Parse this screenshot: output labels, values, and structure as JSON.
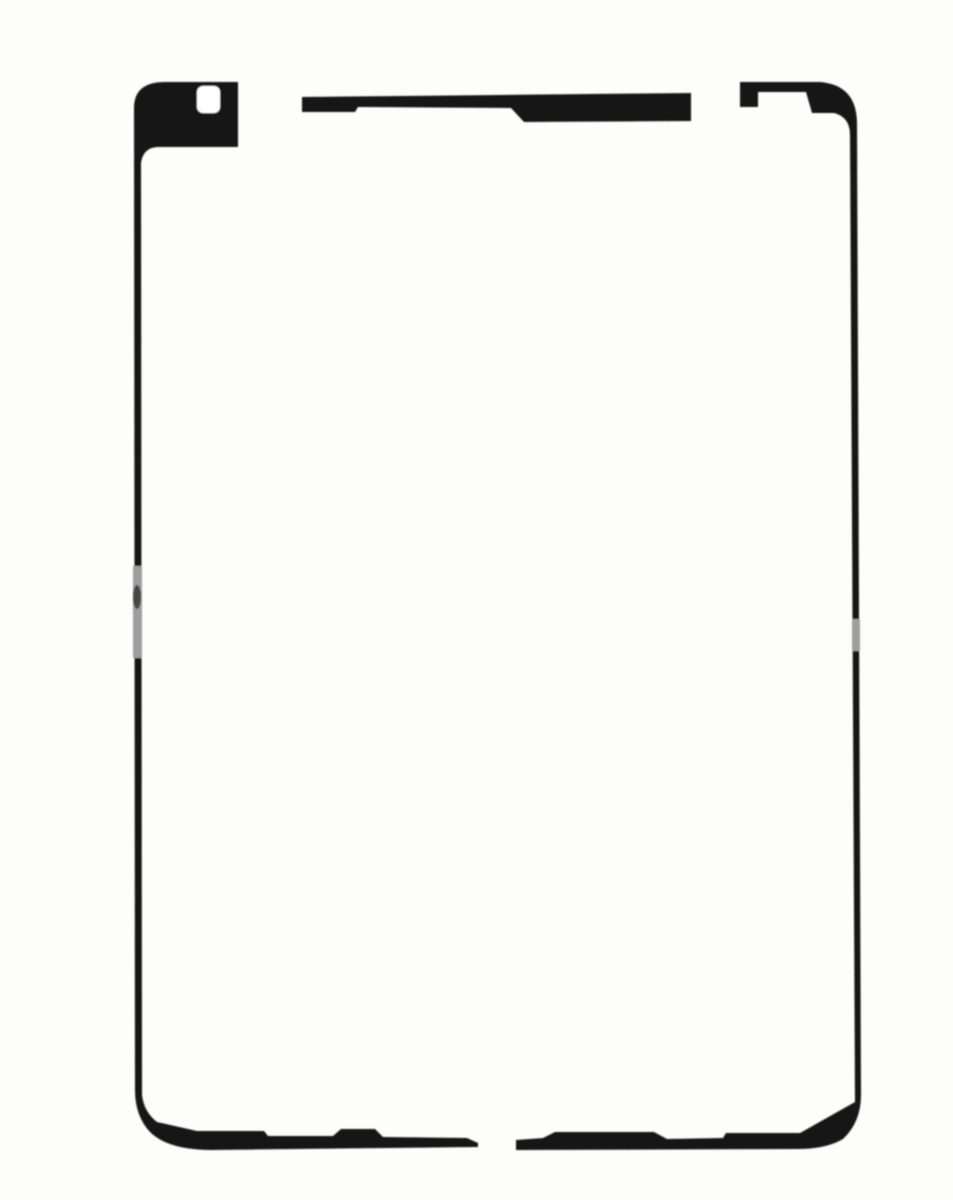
{
  "photo": {
    "subject": "Pre-cut black adhesive gasket strips for a tablet touchscreen, photographed on a white backdrop",
    "pieces": {
      "left": "left adhesive strip with camera tab and camera cutout, wrapping around the bottom-left corner",
      "top": "separate stepped top-edge adhesive strip",
      "right": "right adhesive strip with notched top tab, wrapping around the bottom-right corner"
    }
  },
  "colors": {
    "background": "#fdfdfc",
    "adhesive": "#121212",
    "camera_hole": "#ffffff",
    "watermark_light": "#9e9e9e",
    "watermark_dark": "#474747"
  }
}
